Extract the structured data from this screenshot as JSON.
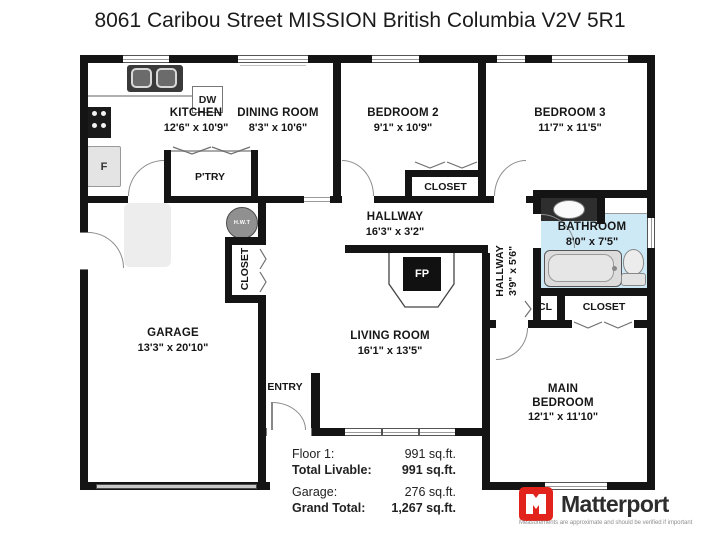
{
  "title": "8061 Caribou Street MISSION British Columbia V2V 5R1",
  "rooms": {
    "kitchen": {
      "name": "KITCHEN",
      "dims": "12'6\" x 10'9\""
    },
    "dining_room": {
      "name": "DINING ROOM",
      "dims": "8'3\" x 10'6\""
    },
    "bedroom2": {
      "name": "BEDROOM 2",
      "dims": "9'1\" x 10'9\""
    },
    "bedroom3": {
      "name": "BEDROOM 3",
      "dims": "11'7\" x 11'5\""
    },
    "hallway": {
      "name": "HALLWAY",
      "dims": "16'3\" x 3'2\""
    },
    "hallway2": {
      "name": "HALLWAY",
      "dims": "3'9\" x 5'6\""
    },
    "bathroom": {
      "name": "BATHROOM",
      "dims": "8'0\" x 7'5\""
    },
    "garage": {
      "name": "GARAGE",
      "dims": "13'3\" x 20'10\""
    },
    "living_room": {
      "name": "LIVING ROOM",
      "dims": "16'1\" x 13'5\""
    },
    "main_bedroom": {
      "name": "MAIN BEDROOM",
      "dims": "12'1\" x 11'10\""
    },
    "entry": {
      "name": "ENTRY"
    },
    "pantry": {
      "name": "P'TRY"
    }
  },
  "fixtures": {
    "dishwasher": "DW",
    "fridge": "F",
    "hot_water_tank": "H.W.T",
    "fireplace": "FP",
    "closet": "CLOSET",
    "closet_small": "CL"
  },
  "totals": {
    "rows": [
      {
        "label": "Floor 1:",
        "value": "991 sq.ft."
      },
      {
        "label": "Total Livable:",
        "value": "991 sq.ft."
      },
      {
        "label": "Garage:",
        "value": "276 sq.ft."
      },
      {
        "label": "Grand Total:",
        "value": "1,267 sq.ft."
      }
    ]
  },
  "branding": {
    "logo_text": "Matterport",
    "tagline": "Measurements are approximate and should be verified if important"
  },
  "colors": {
    "wall": "#141414",
    "bathroom_fill": "#cde9f6",
    "logo_red": "#e2231b",
    "window_frame": "#555555"
  }
}
